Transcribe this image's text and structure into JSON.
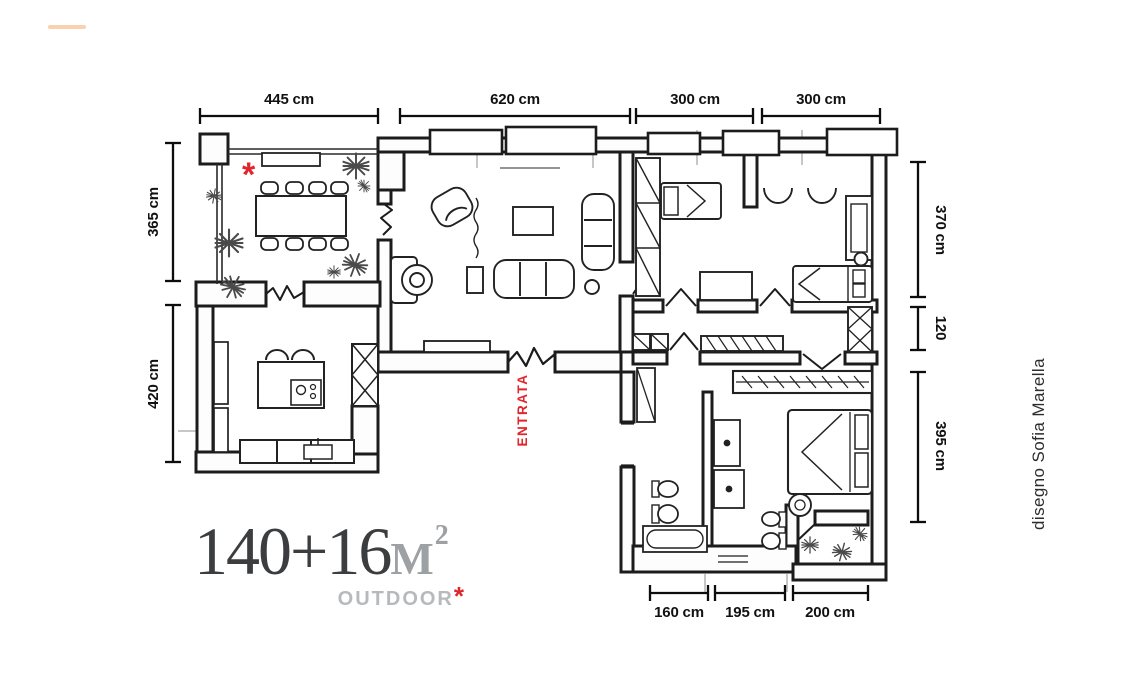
{
  "canvas": {
    "background": "#ffffff"
  },
  "watermark": {
    "color": "#f6c9a2"
  },
  "plan": {
    "ink_color": "#1c1c1c",
    "accent_red": "#e2252b",
    "entrance_label": "ENTRATA",
    "terrace_asterisk": "*",
    "dimensions": {
      "top": [
        "445 cm",
        "620 cm",
        "300 cm",
        "300 cm"
      ],
      "left": [
        "365 cm",
        "420 cm"
      ],
      "right": [
        "370 cm",
        "120",
        "395 cm"
      ],
      "bottom": [
        "160 cm",
        "195 cm",
        "200 cm"
      ]
    }
  },
  "title": {
    "area": "140+16",
    "unit_letter": "M",
    "unit_exponent": "2",
    "subtitle": "OUTDOOR",
    "subtitle_asterisk": "*",
    "dark_color": "#3b3d3f",
    "gray_color": "#9da1a4",
    "subtitle_color": "#b7babc"
  },
  "credit": {
    "text": "disegno Sofia Marella"
  }
}
